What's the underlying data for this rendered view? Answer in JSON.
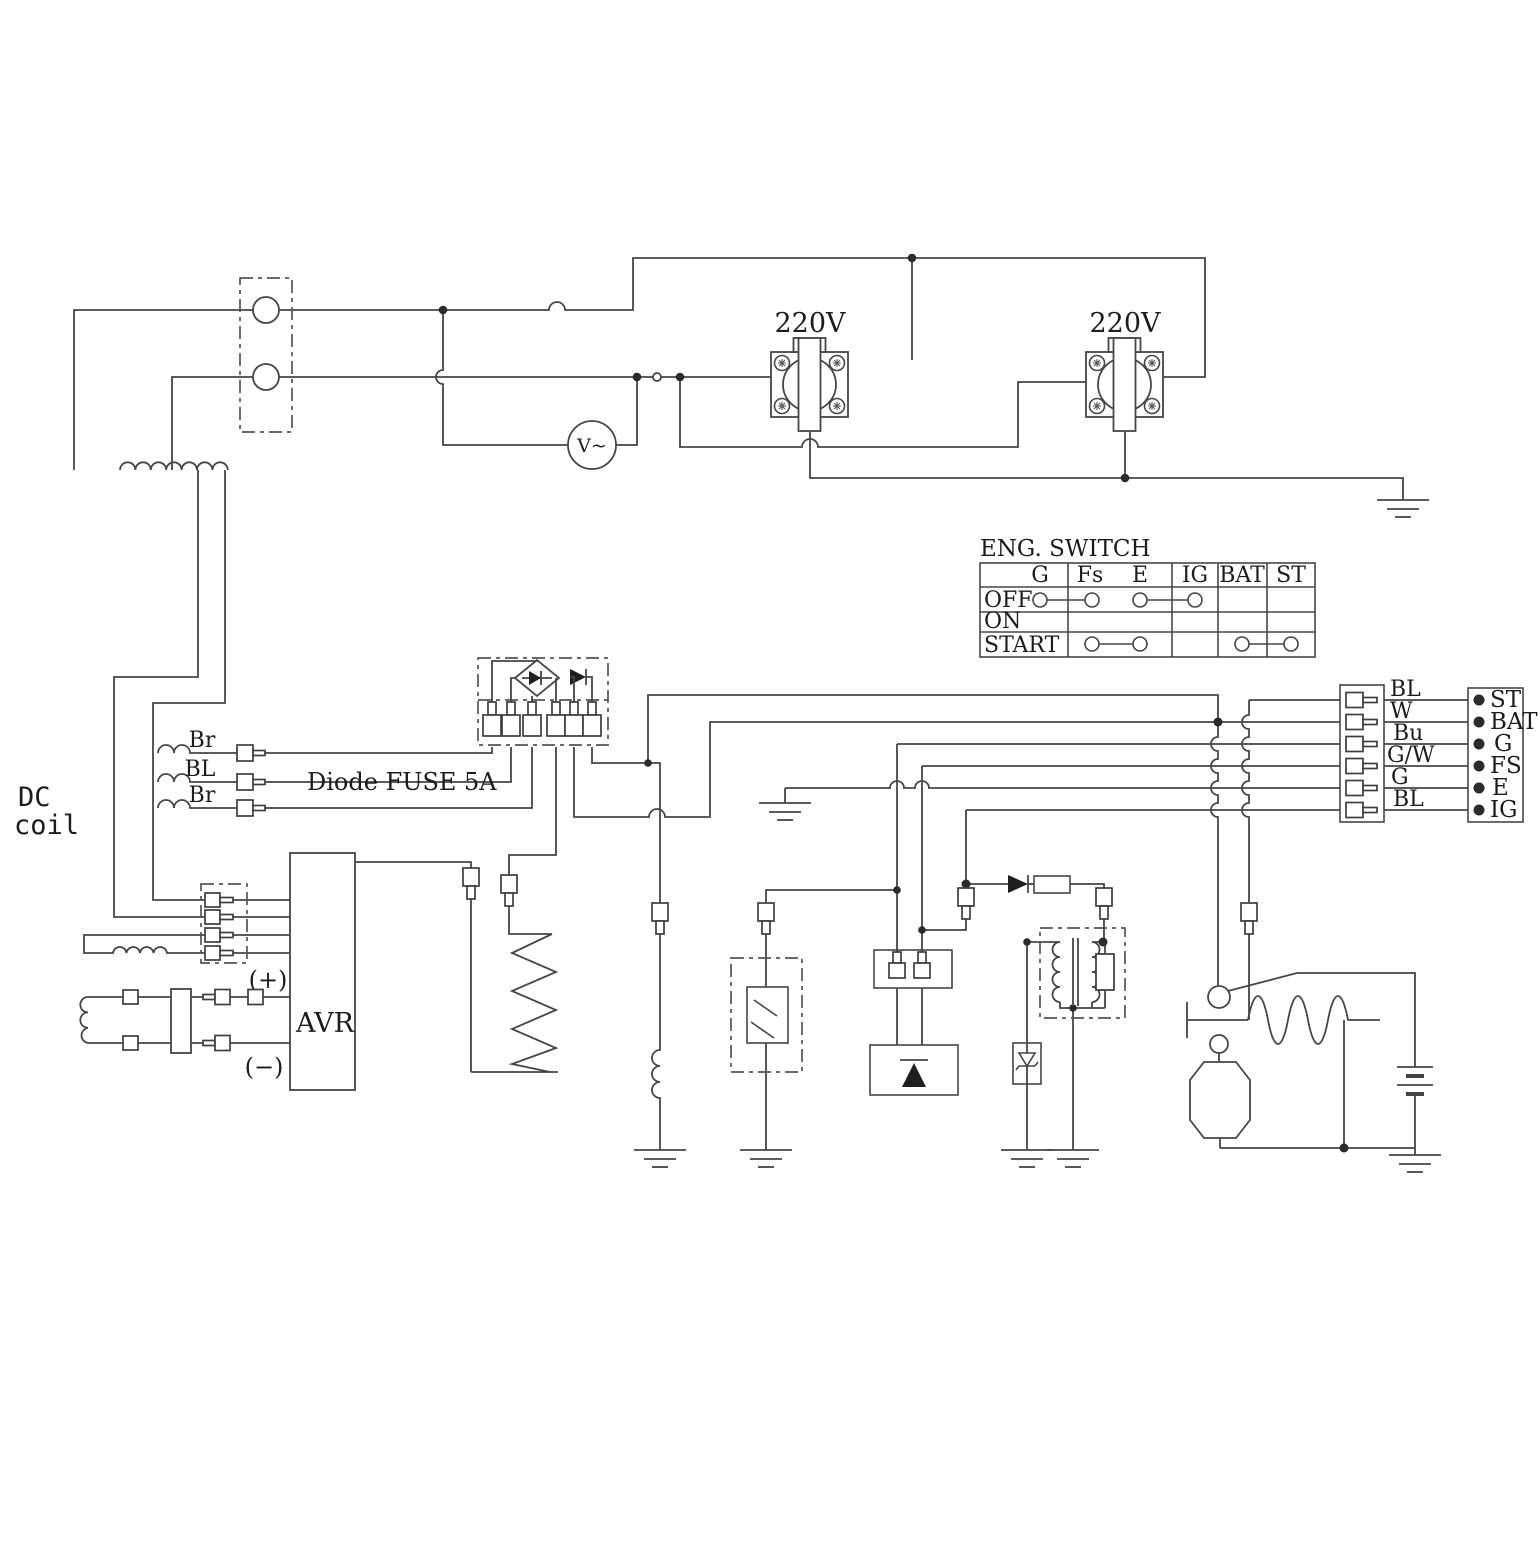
{
  "diagram": {
    "dc_coil": {
      "line1": "DC",
      "line2": "coil"
    },
    "stator_wires": {
      "top": "Br",
      "middle": "BL",
      "bottom": "Br"
    },
    "diode_fuse_label": "Diode FUSE 5A",
    "avr": {
      "label": "AVR",
      "plus": "(+)",
      "minus": "(−)"
    },
    "voltmeter": {
      "label": "V~"
    },
    "outlets": [
      {
        "voltage": "220V"
      },
      {
        "voltage": "220V"
      }
    ],
    "switch_table": {
      "title": "ENG. SWITCH",
      "columns": [
        "G",
        "Fs",
        "E",
        "IG",
        "BAT",
        "ST"
      ],
      "rows": [
        "OFF",
        "ON",
        "START"
      ],
      "contacts": [
        {
          "row": "OFF",
          "linked": [
            [
              "G",
              "Fs"
            ],
            [
              "E",
              "IG"
            ]
          ]
        },
        {
          "row": "ON",
          "linked": []
        },
        {
          "row": "START",
          "linked": [
            [
              "Fs",
              "E"
            ],
            [
              "BAT",
              "ST"
            ]
          ]
        }
      ]
    },
    "harness_connector": {
      "wire_labels": [
        "BL",
        "W",
        "Bu",
        "G/W",
        "G",
        "BL"
      ]
    },
    "terminal_strip": {
      "labels": [
        "ST",
        "BAT",
        "G",
        "FS",
        "E",
        "IG"
      ]
    }
  }
}
